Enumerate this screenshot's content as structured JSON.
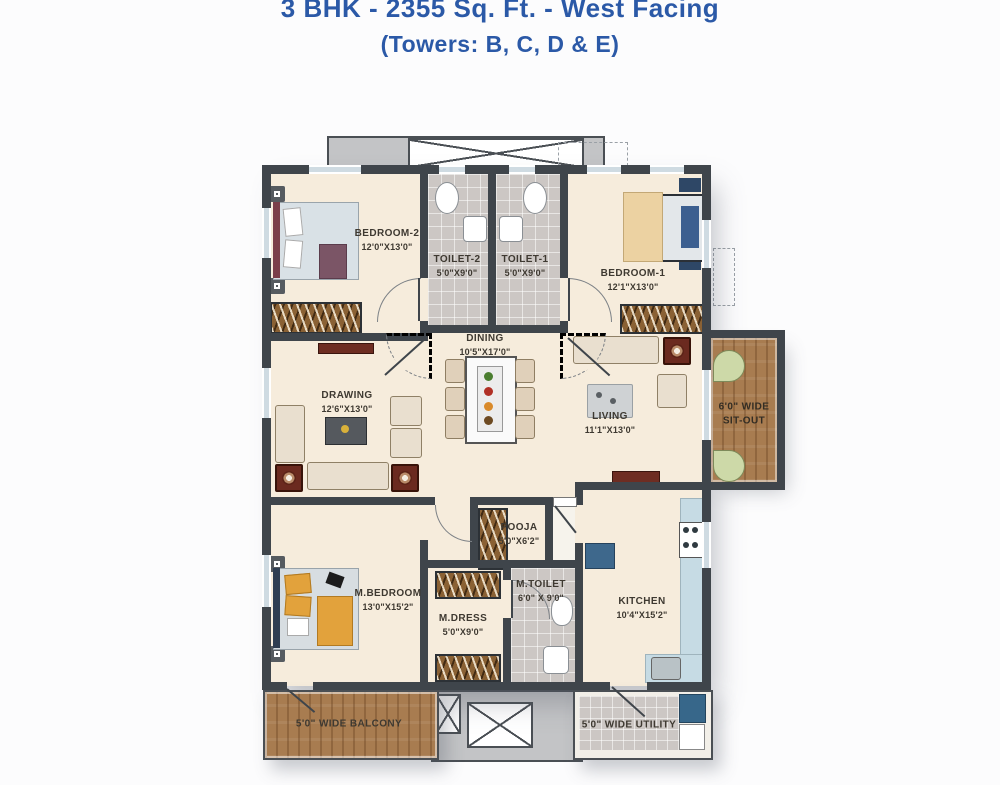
{
  "header": {
    "title": "3 BHK - 2355 Sq. Ft. - West Facing",
    "towers": "(Towers: B, C, D & E)",
    "accent_color": "#2b59a7"
  },
  "rooms": {
    "bedroom2": {
      "name": "BEDROOM-2",
      "dims": "12'0\"X13'0\""
    },
    "toilet2": {
      "name": "TOILET-2",
      "dims": "5'0\"X9'0\""
    },
    "toilet1": {
      "name": "TOILET-1",
      "dims": "5'0\"X9'0\""
    },
    "bedroom1": {
      "name": "BEDROOM-1",
      "dims": "12'1\"X13'0\""
    },
    "dining": {
      "name": "DINING",
      "dims": "10'5\"X17'0\""
    },
    "drawing": {
      "name": "DRAWING",
      "dims": "12'6\"X13'0\""
    },
    "living": {
      "name": "LIVING",
      "dims": "11'1\"X13'0\""
    },
    "sitout": {
      "line1": "6'0\" WIDE",
      "line2": "SIT-OUT"
    },
    "pooja": {
      "name": "POOJA",
      "dims": "5'0\"X6'2\""
    },
    "mbedroom": {
      "name": "M.BEDROOM",
      "dims": "13'0\"X15'2\""
    },
    "mdress": {
      "name": "M.DRESS",
      "dims": "5'0\"X9'0\""
    },
    "mtoilet": {
      "name": "M.TOILET",
      "dims": "6'0\" X 9'0\""
    },
    "kitchen": {
      "name": "KITCHEN",
      "dims": "10'4\"X15'2\""
    },
    "balcony": {
      "label": "5'0\" WIDE BALCONY"
    },
    "utility": {
      "label": "5'0\" WIDE UTILITY"
    }
  },
  "colors": {
    "wall": "#3f454b",
    "floor": "#f6ecdc",
    "wet_tile": "#ccc7c4",
    "wood": "#a87c50",
    "kitchen_counter": "#c6dbe4",
    "label_text": "#3e3931"
  }
}
